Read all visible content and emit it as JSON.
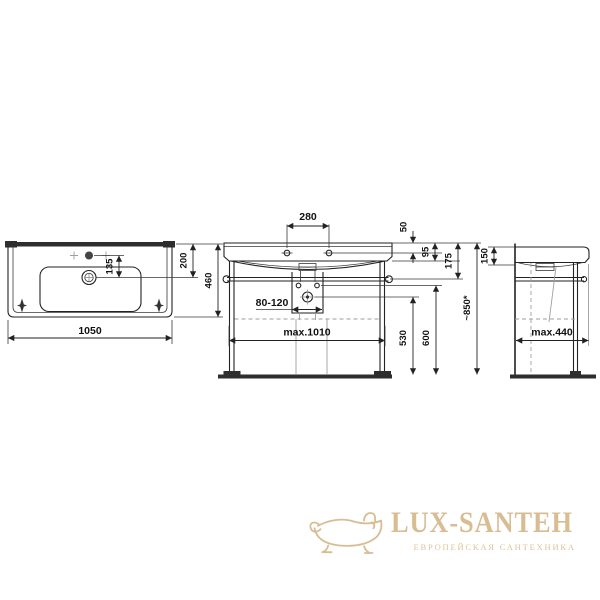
{
  "drawing": {
    "stroke_color": "#222222",
    "dim_color": "#111111",
    "hidden_color": "#9e9e9e",
    "floor_color": "#2e2e2e",
    "labels": {
      "top_width": "1050",
      "hole_to_drain": "135",
      "edge_to_drain": "200",
      "depth": "460",
      "tap_spacing": "280",
      "top_to_holes": "50",
      "top_to_apron": "95",
      "top_to_rail": "175",
      "outlet_range": "80-120",
      "frame_width": "max.1010",
      "outlet_height": "530",
      "fixing_height": "600",
      "total_height": "~850*",
      "side_rim_height": "150",
      "side_depth": "max.440"
    }
  },
  "logo": {
    "brand": "LUX-SANTEH",
    "tagline": "ЕВРОПЕЙСКАЯ САНТЕХНИКА",
    "color": "#d8bd93"
  }
}
